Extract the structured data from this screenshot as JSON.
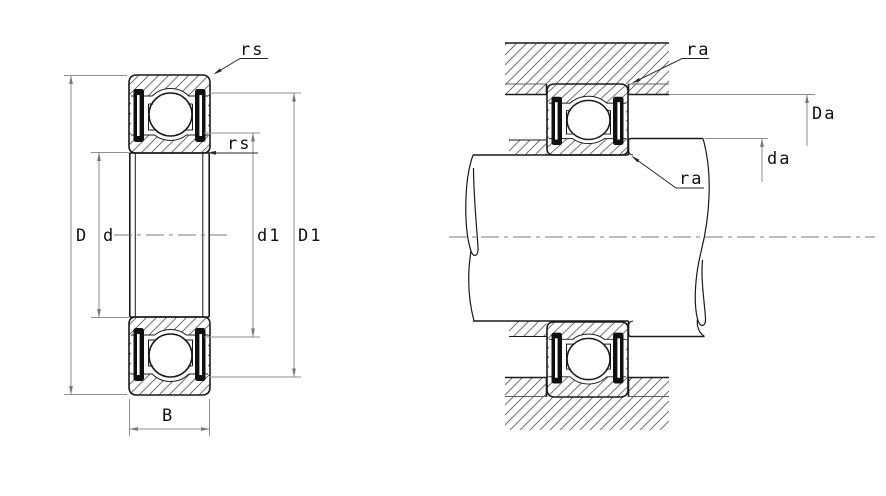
{
  "figure": {
    "section_view": {
      "labels": {
        "outer_dia": "D",
        "bore_dia": "d",
        "inner_seal_land": "d1",
        "outer_seal_land": "D1",
        "width": "B",
        "chamfer_outer": "rs",
        "chamfer_inner": "rs"
      }
    },
    "mounting_view": {
      "labels": {
        "housing_fillet": "ra",
        "shaft_fillet": "ra",
        "housing_abutment_dia": "Da",
        "shaft_abutment_dia": "da"
      }
    },
    "colors": {
      "outline": "#1a1a1a",
      "hatch": "#5f5f5f",
      "dimension": "#8f8f8f",
      "text": "#111111",
      "seal": "#101010",
      "background": "#ffffff"
    }
  }
}
